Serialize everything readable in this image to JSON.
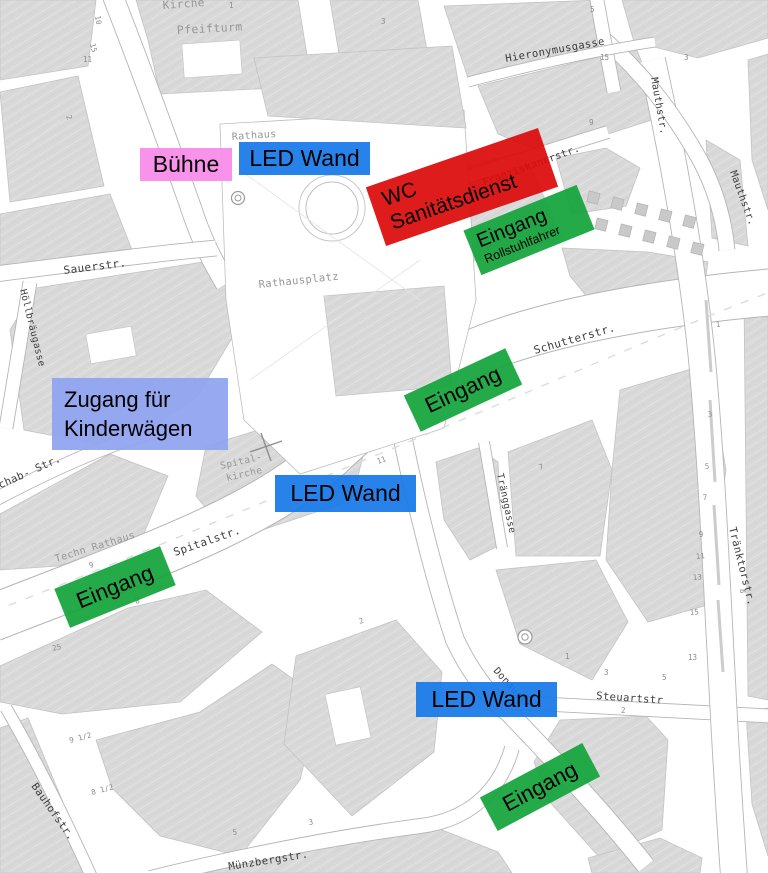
{
  "map": {
    "street_labels": [
      "Sauerstr.",
      "Höllbräugasse",
      "Hieronymusgasse",
      "Mauthstr.",
      "Mauthstr.",
      "Franziskanerstr.",
      "Schutterstr.",
      "Tränggasse",
      "Spitalstr.",
      "nschab- Str.",
      "Tränktorstr.",
      "Steuartstr",
      "Donaustr.",
      "Bauhofstr.",
      "Münzbergstr."
    ],
    "place_labels": [
      "Kirche",
      "Pfeifturm",
      "Rathaus",
      "Rathausplatz",
      "Techn Rathaus",
      "Spital-",
      "kirche"
    ],
    "house_numbers": [
      {
        "t": "3",
        "x": 381,
        "y": 24,
        "r": 0
      },
      {
        "t": "1",
        "x": 229,
        "y": 8,
        "r": 0
      },
      {
        "t": "10",
        "x": 95,
        "y": 16,
        "r": 80
      },
      {
        "t": "15",
        "x": 90,
        "y": 44,
        "r": 75
      },
      {
        "t": "11",
        "x": 83,
        "y": 62,
        "r": 0
      },
      {
        "t": "2",
        "x": 66,
        "y": 116,
        "r": 72
      },
      {
        "t": "15",
        "x": 600,
        "y": 60,
        "r": 0
      },
      {
        "t": "9",
        "x": 589,
        "y": 125,
        "r": 0
      },
      {
        "t": "5",
        "x": 590,
        "y": 12,
        "r": 0
      },
      {
        "t": "1",
        "x": 716,
        "y": 327,
        "r": -5
      },
      {
        "t": "3",
        "x": 708,
        "y": 417,
        "r": -5
      },
      {
        "t": "5",
        "x": 705,
        "y": 469,
        "r": -5
      },
      {
        "t": "7",
        "x": 703,
        "y": 500,
        "r": -5
      },
      {
        "t": "9",
        "x": 699,
        "y": 537,
        "r": -5
      },
      {
        "t": "11",
        "x": 696,
        "y": 559,
        "r": -5
      },
      {
        "t": "13",
        "x": 693,
        "y": 580,
        "r": -5
      },
      {
        "t": "15",
        "x": 690,
        "y": 615,
        "r": -5
      },
      {
        "t": "9",
        "x": 745,
        "y": 594,
        "r": -80
      },
      {
        "t": "3",
        "x": 604,
        "y": 675,
        "r": 0
      },
      {
        "t": "5",
        "x": 662,
        "y": 680,
        "r": 0
      },
      {
        "t": "2",
        "x": 621,
        "y": 713,
        "r": 0
      },
      {
        "t": "13",
        "x": 688,
        "y": 660,
        "r": 0
      },
      {
        "t": "5",
        "x": 233,
        "y": 835,
        "r": -8
      },
      {
        "t": "3",
        "x": 309,
        "y": 825,
        "r": -8
      },
      {
        "t": "1",
        "x": 565,
        "y": 659,
        "r": 0
      },
      {
        "t": "11",
        "x": 378,
        "y": 464,
        "r": -20
      },
      {
        "t": "8",
        "x": 136,
        "y": 604,
        "r": -20
      },
      {
        "t": "9",
        "x": 90,
        "y": 568,
        "r": -20
      },
      {
        "t": "25",
        "x": 53,
        "y": 651,
        "r": -15
      },
      {
        "t": "9 1/2",
        "x": 70,
        "y": 743,
        "r": -15
      },
      {
        "t": "8 1/2",
        "x": 92,
        "y": 795,
        "r": -15
      },
      {
        "t": "2",
        "x": 360,
        "y": 624,
        "r": -20
      },
      {
        "t": "7",
        "x": 540,
        "y": 470,
        "r": -20
      },
      {
        "t": "3",
        "x": 684,
        "y": 60,
        "r": 0
      }
    ]
  },
  "annotations": {
    "buehne": {
      "label": "Bühne",
      "color": "#F98AE8"
    },
    "led_wand_top": {
      "label": "LED Wand",
      "color": "#1779E8"
    },
    "wc_sanitaetsdienst": {
      "line1": "WC",
      "line2": "Sanitätsdienst",
      "color": "#DB0B0B"
    },
    "eingang_rollstuhlfahrer": {
      "line1": "Eingang",
      "line2": "Rollstuhlfahrer",
      "color": "#14A43C"
    },
    "eingang_mitte": {
      "label": "Eingang",
      "color": "#14A43C"
    },
    "zugang_kinderwaegen": {
      "line1": "Zugang für",
      "line2": "Kinderwägen",
      "color": "#8FA2EF"
    },
    "led_wand_mitte": {
      "label": "LED Wand",
      "color": "#1779E8"
    },
    "eingang_links": {
      "label": "Eingang",
      "color": "#14A43C"
    },
    "led_wand_unten": {
      "label": "LED Wand",
      "color": "#1779E8"
    },
    "eingang_unten": {
      "label": "Eingang",
      "color": "#14A43C"
    }
  }
}
